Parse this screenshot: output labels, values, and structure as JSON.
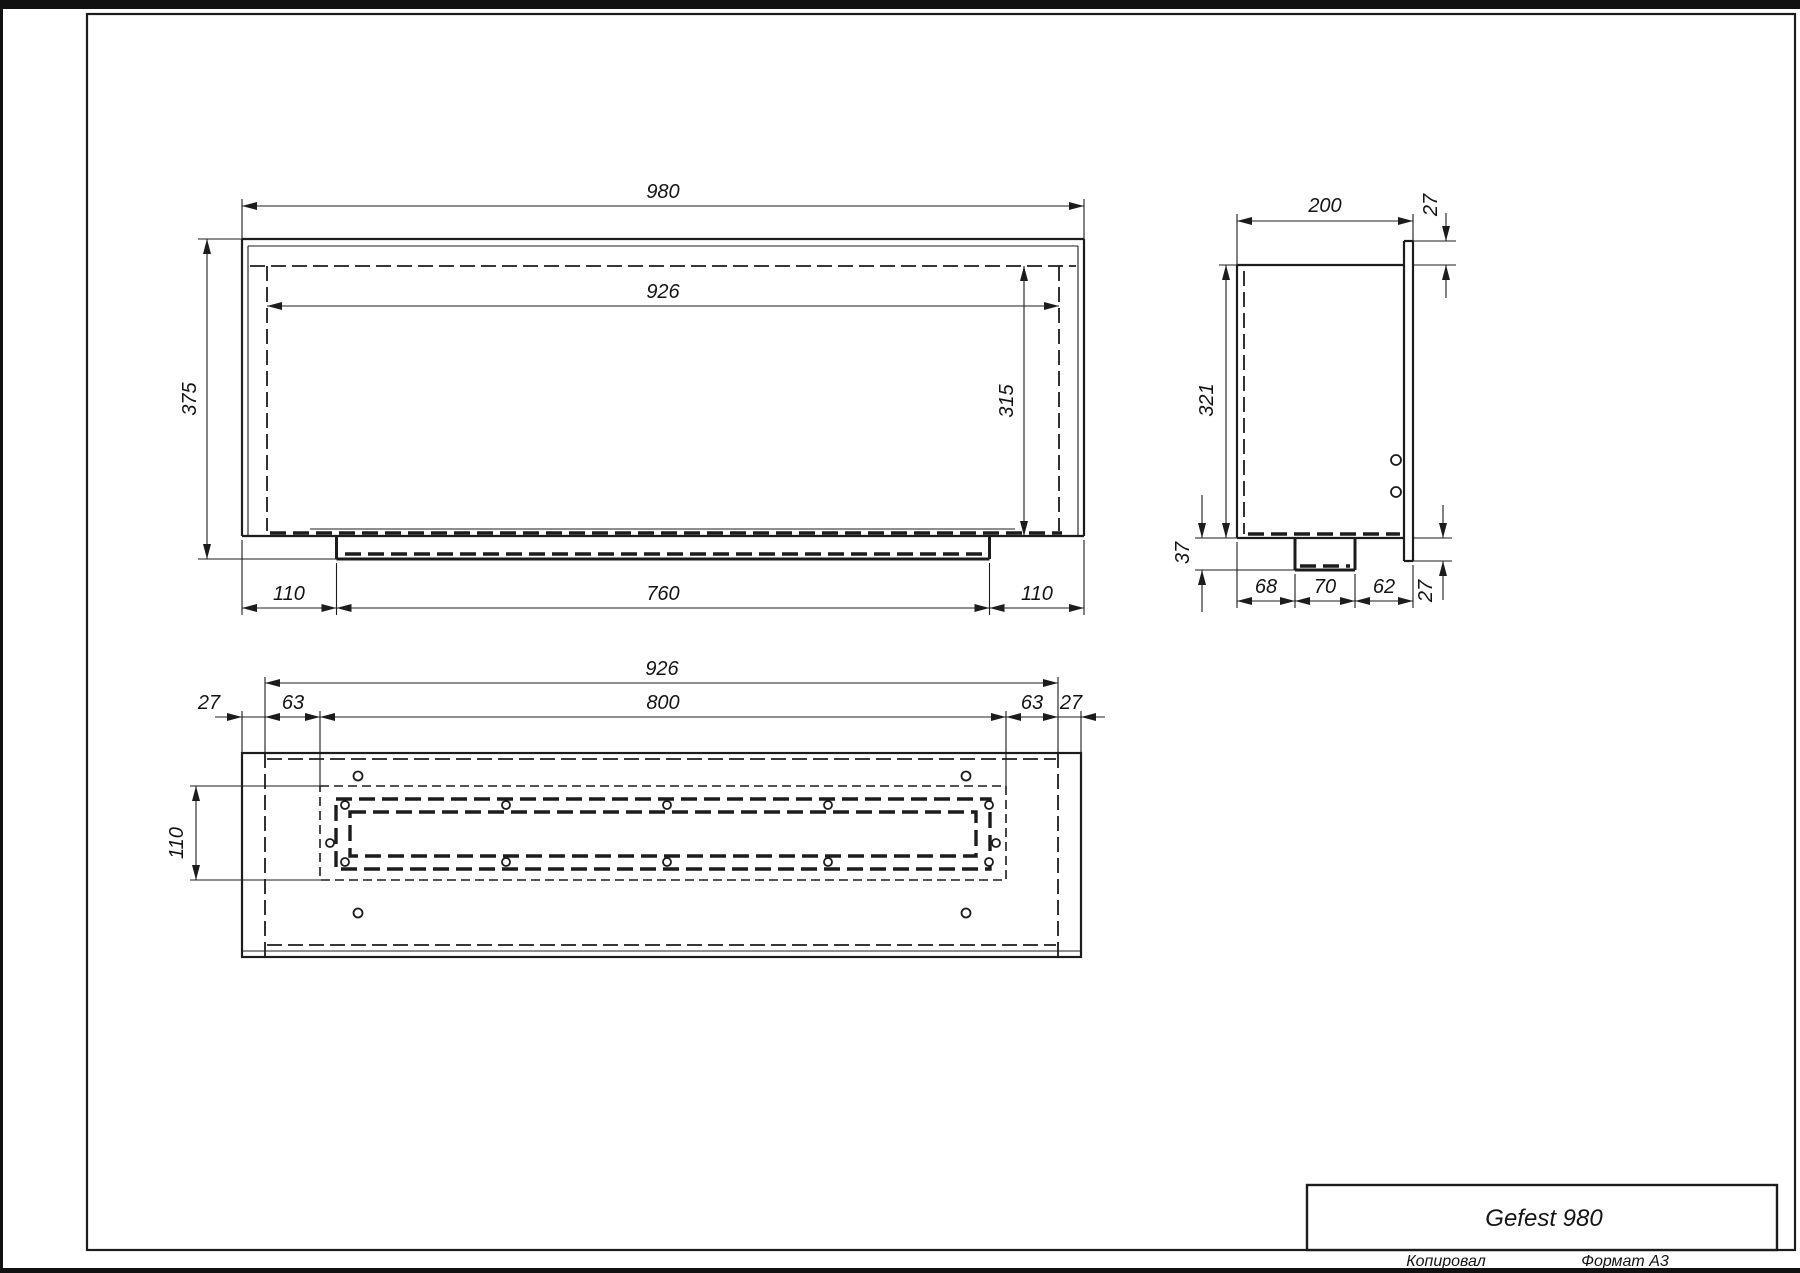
{
  "title_block": {
    "model": "Gefest 980",
    "copied_label": "Копировал",
    "format_label": "Формат А3"
  },
  "front_view": {
    "overall_width": "980",
    "inner_width": "926",
    "overall_height": "375",
    "inner_height": "315",
    "bottom_left_offset": "110",
    "burner_width": "760",
    "bottom_right_offset": "110"
  },
  "side_view": {
    "depth": "200",
    "flange_top_offset": "27",
    "body_height": "321",
    "tray_depth": "37",
    "bottom_left": "68",
    "bottom_center": "70",
    "bottom_right": "62",
    "flange_bottom_offset": "27"
  },
  "bottom_view": {
    "body_width": "926",
    "slot_width": "800",
    "left_flange": "27",
    "left_offset": "63",
    "right_offset": "63",
    "right_flange": "27",
    "slot_height": "110"
  },
  "colors": {
    "line": "#1c1c1c",
    "background": "#ffffff"
  }
}
